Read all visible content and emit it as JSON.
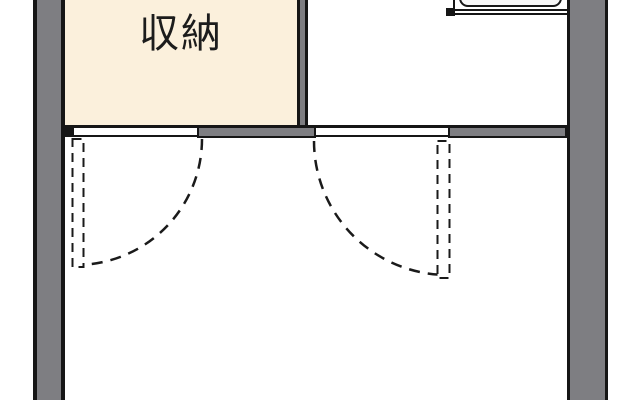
{
  "diagram_type": "floor-plan",
  "rooms": {
    "storage": {
      "label": "収納",
      "fill": "#fbf0dc"
    },
    "upper_right": {
      "fill": "#ffffff"
    },
    "lower": {
      "fill": "#ffffff"
    }
  },
  "colors": {
    "wall_fill": "#7e7e82",
    "wall_outline": "#161616",
    "storage_room_fill": "#fbf0dc",
    "line_black": "#1a1a1a",
    "sink_fill": "#f6f6f6",
    "paper": "#ffffff"
  },
  "icons": {
    "kitchen_sink": "kitchen-sink-icon",
    "door_leaf": "door-leaf-icon",
    "door_swing": "door-swing-arc-icon"
  }
}
